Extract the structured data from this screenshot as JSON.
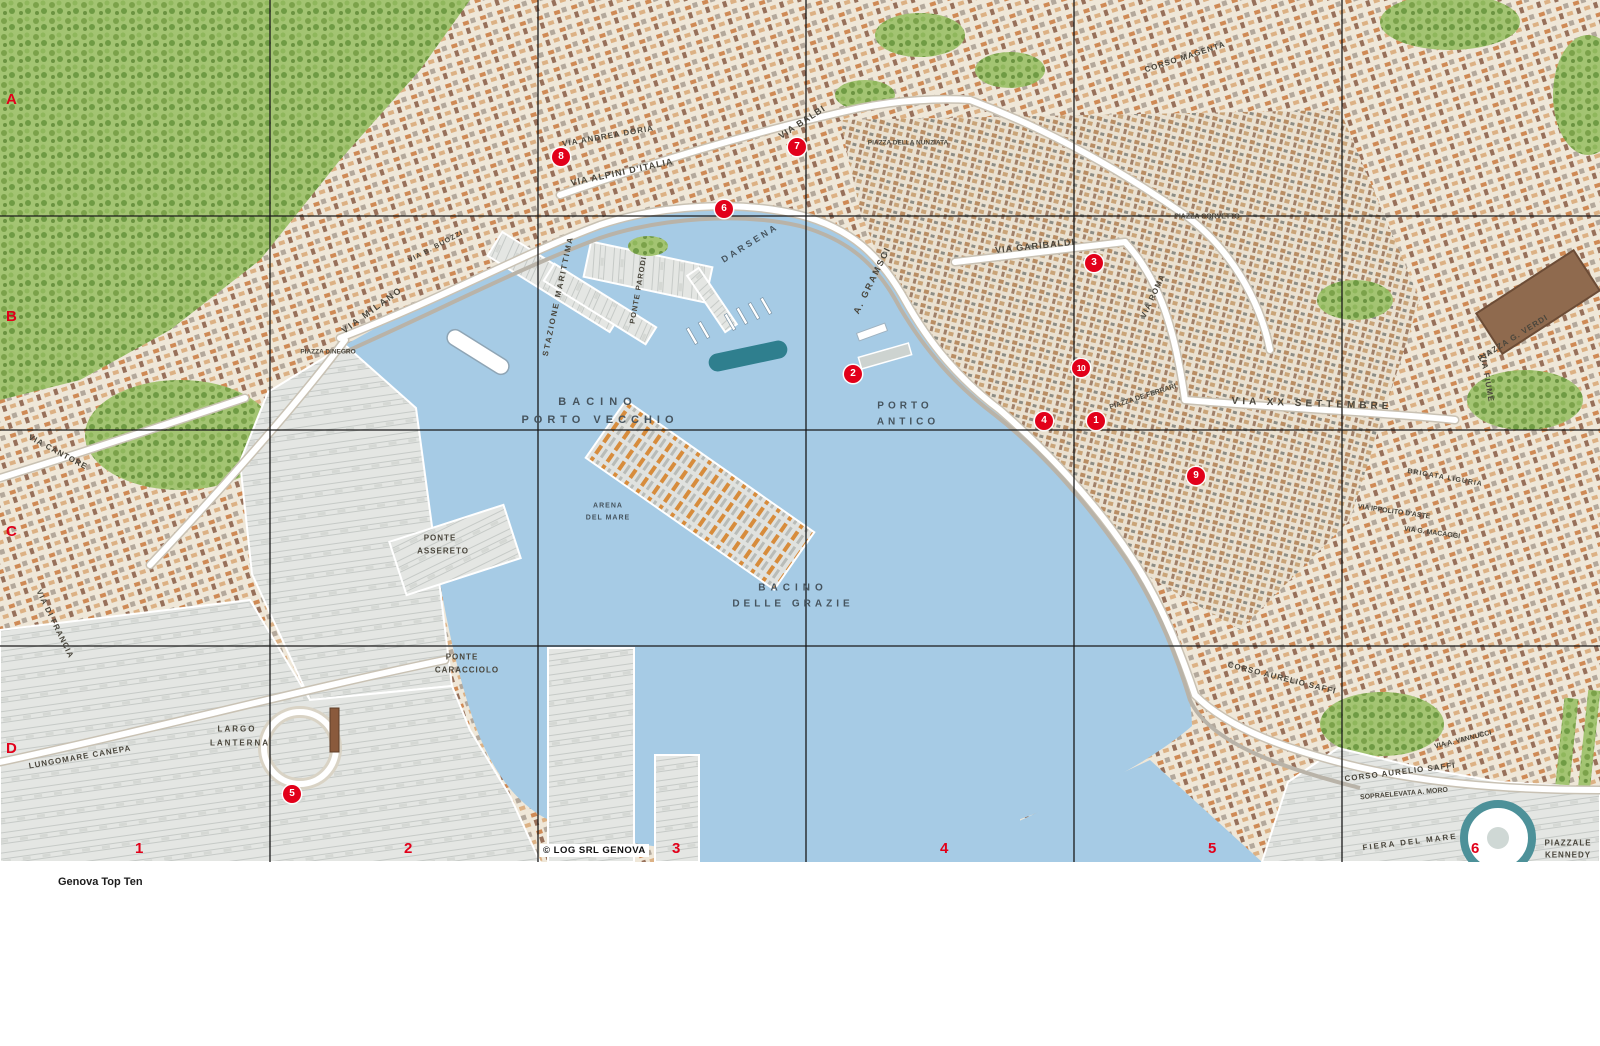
{
  "colors": {
    "accent_red": "#e2001a",
    "water": "#a6cbe5",
    "land": "#efe8da",
    "green": "#a3c472",
    "port": "#e4e6e3",
    "grid_line": "#1a1a1a"
  },
  "map": {
    "copyright": "© LOG SRL GENOVA",
    "grid": {
      "cols": [
        {
          "t": "1",
          "x": 135
        },
        {
          "t": "2",
          "x": 404
        },
        {
          "t": "3",
          "x": 672
        },
        {
          "t": "4",
          "x": 940
        },
        {
          "t": "5",
          "x": 1208
        },
        {
          "t": "6",
          "x": 1471
        }
      ],
      "rows": [
        {
          "t": "A",
          "y": 99
        },
        {
          "t": "B",
          "y": 316
        },
        {
          "t": "C",
          "y": 531
        },
        {
          "t": "D",
          "y": 748
        }
      ]
    },
    "markers": [
      {
        "n": "1",
        "x": 1096,
        "y": 421
      },
      {
        "n": "2",
        "x": 853,
        "y": 374
      },
      {
        "n": "3",
        "x": 1094,
        "y": 263
      },
      {
        "n": "4",
        "x": 1044,
        "y": 421
      },
      {
        "n": "5",
        "x": 292,
        "y": 794
      },
      {
        "n": "6",
        "x": 724,
        "y": 209
      },
      {
        "n": "7",
        "x": 797,
        "y": 147
      },
      {
        "n": "8",
        "x": 561,
        "y": 157
      },
      {
        "n": "9",
        "x": 1196,
        "y": 476
      },
      {
        "n": "10",
        "x": 1081,
        "y": 368
      }
    ],
    "labels": [
      {
        "t": "BACINO",
        "x": 598,
        "y": 402,
        "r": 0,
        "s": 11,
        "sp": 6,
        "w": 1
      },
      {
        "t": "PORTO VECCHIO",
        "x": 600,
        "y": 420,
        "r": 0,
        "s": 11,
        "sp": 5,
        "w": 1
      },
      {
        "t": "PORTO",
        "x": 905,
        "y": 406,
        "r": 0,
        "s": 10,
        "sp": 4,
        "w": 1
      },
      {
        "t": "ANTICO",
        "x": 908,
        "y": 422,
        "r": 0,
        "s": 10,
        "sp": 4,
        "w": 1
      },
      {
        "t": "BACINO",
        "x": 793,
        "y": 588,
        "r": 0,
        "s": 10,
        "sp": 5,
        "w": 1
      },
      {
        "t": "DELLE GRAZIE",
        "x": 793,
        "y": 604,
        "r": 0,
        "s": 10,
        "sp": 4,
        "w": 1
      },
      {
        "t": "DARSENA",
        "x": 750,
        "y": 243,
        "r": -32,
        "s": 9,
        "sp": 3,
        "w": 1
      },
      {
        "t": "VIA ANDREA DORIA",
        "x": 608,
        "y": 136,
        "r": -10,
        "s": 8,
        "sp": 1
      },
      {
        "t": "VIA ALPINI D'ITALIA",
        "x": 622,
        "y": 172,
        "r": -12,
        "s": 9,
        "sp": 1
      },
      {
        "t": "VIA BALBI",
        "x": 802,
        "y": 122,
        "r": -33,
        "s": 9,
        "sp": 1
      },
      {
        "t": "A. GRAMSCI",
        "x": 872,
        "y": 280,
        "r": -64,
        "s": 9,
        "sp": 2
      },
      {
        "t": "VIA GARIBALDI",
        "x": 1035,
        "y": 246,
        "r": -6,
        "s": 9,
        "sp": 1
      },
      {
        "t": "PIAZZA CORVETTO",
        "x": 1207,
        "y": 217,
        "r": 0,
        "s": 7,
        "sp": 0
      },
      {
        "t": "VIA ROMA",
        "x": 1153,
        "y": 296,
        "r": -65,
        "s": 8,
        "sp": 1
      },
      {
        "t": "PIAZZA DE FERRARI",
        "x": 1143,
        "y": 397,
        "r": -18,
        "s": 7,
        "sp": 0
      },
      {
        "t": "VIA XX SETTEMBRE",
        "x": 1312,
        "y": 404,
        "r": 2,
        "s": 10,
        "sp": 4
      },
      {
        "t": "STAZIONE MARITTIMA",
        "x": 558,
        "y": 296,
        "r": -78,
        "s": 8,
        "sp": 2
      },
      {
        "t": "PONTE PARODI",
        "x": 638,
        "y": 290,
        "r": -80,
        "s": 7.5,
        "sp": 1
      },
      {
        "t": "PONTE",
        "x": 440,
        "y": 538,
        "r": 0,
        "s": 8,
        "sp": 1
      },
      {
        "t": "ASSERETO",
        "x": 443,
        "y": 551,
        "r": 0,
        "s": 8,
        "sp": 1
      },
      {
        "t": "PONTE",
        "x": 462,
        "y": 657,
        "r": 0,
        "s": 8,
        "sp": 1
      },
      {
        "t": "CARACCIOLO",
        "x": 467,
        "y": 670,
        "r": 0,
        "s": 8,
        "sp": 1
      },
      {
        "t": "LARGO",
        "x": 237,
        "y": 729,
        "r": 0,
        "s": 8,
        "sp": 2
      },
      {
        "t": "LANTERNA",
        "x": 240,
        "y": 743,
        "r": 0,
        "s": 8,
        "sp": 2
      },
      {
        "t": "ARENA",
        "x": 608,
        "y": 506,
        "r": 0,
        "s": 7,
        "sp": 1,
        "w": 1
      },
      {
        "t": "DEL MARE",
        "x": 608,
        "y": 518,
        "r": 0,
        "s": 7,
        "sp": 1,
        "w": 1
      },
      {
        "t": "VIA MILANO",
        "x": 372,
        "y": 310,
        "r": -36,
        "s": 9,
        "sp": 2
      },
      {
        "t": "LUNGOMARE CANEPA",
        "x": 80,
        "y": 757,
        "r": -10,
        "s": 8,
        "sp": 1
      },
      {
        "t": "VIA CANTORE",
        "x": 58,
        "y": 452,
        "r": 28,
        "s": 8,
        "sp": 1
      },
      {
        "t": "VIA DI FRANCIA",
        "x": 55,
        "y": 624,
        "r": 64,
        "s": 8,
        "sp": 1
      },
      {
        "t": "PIAZZA DINEGRO",
        "x": 328,
        "y": 352,
        "r": 0,
        "s": 6.5,
        "sp": 0
      },
      {
        "t": "VIA B. BUOZZI",
        "x": 436,
        "y": 247,
        "r": -28,
        "s": 7,
        "sp": 1
      },
      {
        "t": "PIAZZA DELLA NUNZIATA",
        "x": 908,
        "y": 143,
        "r": 0,
        "s": 6.5,
        "sp": 0
      },
      {
        "t": "CORSO MAGENTA",
        "x": 1185,
        "y": 57,
        "r": -18,
        "s": 8,
        "sp": 1
      },
      {
        "t": "CORSO AURELIO SAFFI",
        "x": 1282,
        "y": 678,
        "r": 14,
        "s": 8,
        "sp": 1
      },
      {
        "t": "CORSO AURELIO SAFFI",
        "x": 1400,
        "y": 772,
        "r": -7,
        "s": 8,
        "sp": 1
      },
      {
        "t": "SOPRAELEVATA A. MORO",
        "x": 1404,
        "y": 794,
        "r": -5,
        "s": 7,
        "sp": 0
      },
      {
        "t": "VIA A. VANNUCCI",
        "x": 1463,
        "y": 740,
        "r": -14,
        "s": 7,
        "sp": 0
      },
      {
        "t": "FIERA DEL MARE",
        "x": 1410,
        "y": 842,
        "r": -7,
        "s": 8,
        "sp": 2
      },
      {
        "t": "PIAZZALE",
        "x": 1568,
        "y": 843,
        "r": 0,
        "s": 8,
        "sp": 1
      },
      {
        "t": "KENNEDY",
        "x": 1568,
        "y": 855,
        "r": 0,
        "s": 8,
        "sp": 1
      },
      {
        "t": "PIAZZA G. VERDI",
        "x": 1513,
        "y": 338,
        "r": -32,
        "s": 8,
        "sp": 1
      },
      {
        "t": "VIA FIUME",
        "x": 1487,
        "y": 378,
        "r": 80,
        "s": 8,
        "sp": 1
      },
      {
        "t": "VIA IPPOLITO D'ASTE",
        "x": 1394,
        "y": 512,
        "r": 8,
        "s": 7,
        "sp": 0
      },
      {
        "t": "BRIGATA LIGURIA",
        "x": 1445,
        "y": 478,
        "r": 10,
        "s": 7,
        "sp": 1
      },
      {
        "t": "VIA G. MACAGGI",
        "x": 1432,
        "y": 533,
        "r": 8,
        "s": 7,
        "sp": 0
      },
      {
        "t": "PIAZZA",
        "x": 1205,
        "y": 212,
        "r": 0,
        "s": 0,
        "sp": 0,
        "hide": 1
      }
    ]
  },
  "legend": {
    "top_ten": {
      "title": "Genova Top Ten",
      "columns": [
        {
          "w": 150,
          "items": [
            {
              "n": "1",
              "b": "Palazzo Ducale",
              "t": "sede Infopoint Genova 2004"
            },
            {
              "n": "2",
              "b": "Acquario e Porto Antico",
              "t": "Bigo, Bolla di Renzo Piano, Città dei bambini, Biblioteca De Amicis, Magazzini del Cotone, Museo dell'Antartide, Porta Siberia e Museo Luzzati"
            }
          ]
        },
        {
          "w": 152,
          "items": [
            {
              "n": "3",
              "b": "Via Garibaldi",
              "t": "palazzi Bianco, Rosso, Tursi, Campanella, Carrega Cataldi, Cattaneo Adorno, Doria, Gambaro, Lercari Parodi, Podestà, Pallavicino, Spinola"
            },
            {
              "n": "4",
              "b": "Cattedrale di San Lorenzo e Museo del Tesoro"
            },
            {
              "n": "5",
              "b": "Lanterna e Museo di Genova e della Genovesità"
            }
          ]
        },
        {
          "w": 134,
          "items": [
            {
              "n": "6",
              "b": "Musei del Mare e della Navigazione: Quartiere Galata"
            },
            {
              "n": "7",
              "b": "Palazzo Reale e Galleria Nazionale"
            },
            {
              "n": "8",
              "b": "Palazzo del Principe"
            },
            {
              "n": "9",
              "b": "Casa di Colombo"
            },
            {
              "n": "10",
              "b": "Piazza San Matteo",
              "t": "chiesa e palazzi Doria"
            }
          ]
        }
      ]
    },
    "monuments": {
      "title": "Genova: luoghi e monumenti",
      "columns": [
        {
          "w": 126,
          "items": [
            {
              "H": "Genova: luoghi e monumenti"
            },
            {
              "h": "Ascensori e funicolari"
            },
            {
              "t": "Ascensore di Castelletto",
              "c": "A4"
            },
            {
              "t": "Funicolare Zecca – Righi",
              "c": "A4"
            },
            {
              "h": "Belvedere"
            },
            {
              "t": "Belvedere Montaldo",
              "c": "A4"
            },
            {
              "t": "Corso Podestà – Mura di Santa Chiara",
              "c": "C5"
            },
            {
              "t": "Spianata dell'Acquasola",
              "c": "B5"
            },
            {
              "t": "Biblioteca Berio",
              "c": "C5"
            }
          ]
        },
        {
          "w": 162,
          "items": [
            {
              "h": "Centri congressuali"
            },
            {
              "t": "Cotone Congressi",
              "c": "C3"
            },
            {
              "t": "Fiera del Mare",
              "c": "D6"
            },
            {
              "h": "Chiese"
            },
            {
              "t": "Gesù",
              "c": "B-D5"
            },
            {
              "t": "San Bartolomeo degli Armeni",
              "c": "A5"
            },
            {
              "t": "San Donato",
              "c": "C4"
            },
            {
              "t": "San Filippo e oratorio",
              "c": "B4"
            },
            {
              "t": "San Giovanni di Prè e Commenda",
              "c": "A3"
            },
            {
              "t": "Santa Maria Assunta in Carignano",
              "c": "B-C5"
            },
            {
              "t": "Santa Maria delle Vigne",
              "c": "B4"
            }
          ]
        },
        {
          "w": 146,
          "items": [
            {
              "t": "Santa Maria di Castello",
              "c": "C4"
            },
            {
              "t": "Santa Maria Maddalena",
              "c": "B4"
            },
            {
              "t": "San Pietro in Banchi",
              "c": "B4"
            },
            {
              "t": "Santo Stefano",
              "c": "B5"
            },
            {
              "t": "Santissima Annunziata del Vastato",
              "c": "A4"
            },
            {
              "h": "Musei"
            },
            {
              "t": "Galleria di Palazzo Bianco",
              "c": "B4"
            },
            {
              "t": "Galleria di Palazzo Rosso",
              "c": "B4"
            },
            {
              "t": "Galleria Nazionale di Palazzo Spinola",
              "c": "B4"
            },
            {
              "t": "Galleria d'Arte Moderna di Nervi"
            }
          ]
        },
        {
          "w": 148,
          "items": [
            {
              "t": "Museo del convento di SantaMaria di Castello",
              "c": "C4"
            },
            {
              "t": "Museo dell'Accademia Ligustica di Belle Arti",
              "c": "B5"
            },
            {
              "t": "Museo del Risorgimento e Casa di Mazzini",
              "c": "B4"
            },
            {
              "t": "Museo di Archeologia Ligure di Pegli"
            },
            {
              "t": "Museo di Sant'Agostino",
              "c": "C4"
            },
            {
              "t": "Museo d'Arte Contemporanea di Villa Croce",
              "c": "D6"
            },
            {
              "t": "Museo d'Arte orientale E. Chiossone",
              "c": "A5"
            }
          ]
        },
        {
          "w": 152,
          "items": [
            {
              "t": "Museo Diocesano d'Arte Sacra",
              "c": "B4"
            },
            {
              "t": "Museo Giannettino Luxoro di Nervi"
            },
            {
              "t": "Museo di Storia e Cultura contadina (salita al Garbo)"
            },
            {
              "t": "Museo di Storia Naturale G. Doria",
              "c": "C6"
            },
            {
              "t": "Museo della Cultura ebraica",
              "c": "A5"
            },
            {
              "t": "Castello D'Albertis – Museo delle Culture del mondo",
              "c": "A3"
            },
            {
              "t": "Museo Navale di Pegli"
            },
            {
              "t": "Palazzo Tursi",
              "c": "B4"
            }
          ]
        },
        {
          "w": 128,
          "items": [
            {
              "h": "Palazzi"
            },
            {
              "t": "Albergo dei Poveri",
              "c": "A4"
            },
            {
              "t": "Balbi Senarega",
              "c": "A3"
            },
            {
              "t": "della Borsa",
              "c": "B5"
            },
            {
              "t": "Magazzini dell'Abbondanza",
              "c": "C4"
            },
            {
              "t": "dell'Università",
              "c": "A4"
            },
            {
              "t": "Doria Spinola (Prefettura)",
              "c": "B5"
            },
            {
              "t": "Imperiale a Campetto",
              "c": "B4"
            },
            {
              "t": "Loggia di Banchi",
              "c": "B4"
            },
            {
              "t": "San Giorgio",
              "c": "B4"
            },
            {
              "t": "Stazione Marittima",
              "c": "B3"
            }
          ]
        },
        {
          "w": 190,
          "items": [
            {
              "h": "Teatri"
            },
            {
              "t": "Teatro dell'Opera Carlo Felice",
              "c": "B5"
            },
            {
              "t": "Teatro Stabile di Genova",
              "c": "B6"
            },
            {
              "t": "Teatro Politeama Genovese",
              "c": "A5"
            },
            {
              "t": "Teatro dell'Archivolto (Teatro Modena – Sampierdarena)"
            },
            {
              "t": "Teatro di Campopisano",
              "c": "C5"
            },
            {
              "t": "Teatro Cargo a Voltri"
            },
            {
              "t": "Teatro Garage (Sala Diana – San Fruttuoso)"
            },
            {
              "t": "Teatro della Tosse",
              "c": "C5"
            }
          ]
        }
      ]
    }
  }
}
